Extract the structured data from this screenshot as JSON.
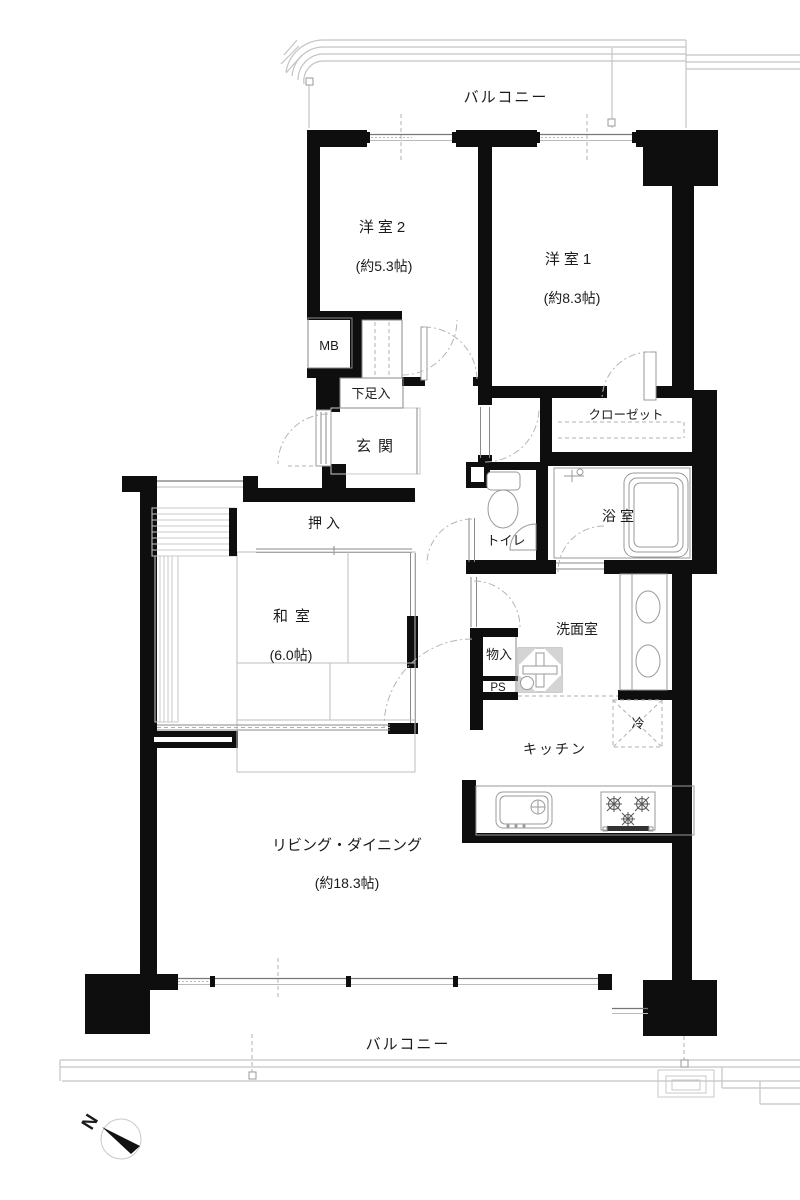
{
  "colors": {
    "wall": "#0e0e0e",
    "line": "#8a8a8a",
    "railing": "#c4c4c4",
    "text": "#1b1b1b"
  },
  "plan": {
    "balcony_top": "バルコニー",
    "balcony_bottom": "バルコニー",
    "western2": {
      "name": "洋室2",
      "size": "(約5.3帖)"
    },
    "western1": {
      "name": "洋室1",
      "size": "(約8.3帖)"
    },
    "japanese_room": {
      "name": "和室",
      "size": "(6.0帖)"
    },
    "living_dining": {
      "name": "リビング・ダイニング",
      "size": "(約18.3帖)"
    },
    "kitchen": "キッチン",
    "washroom": "洗面室",
    "bathroom": "浴室",
    "toilet": "トイレ",
    "entrance": "玄関",
    "closet": "クローゼット",
    "oshiire": "押入",
    "shoe_cabinet": "下足入",
    "storage": "物入",
    "meter_box": "MB",
    "pipe_space": "PS",
    "refrigerator": "冷",
    "compass_north": "N"
  }
}
